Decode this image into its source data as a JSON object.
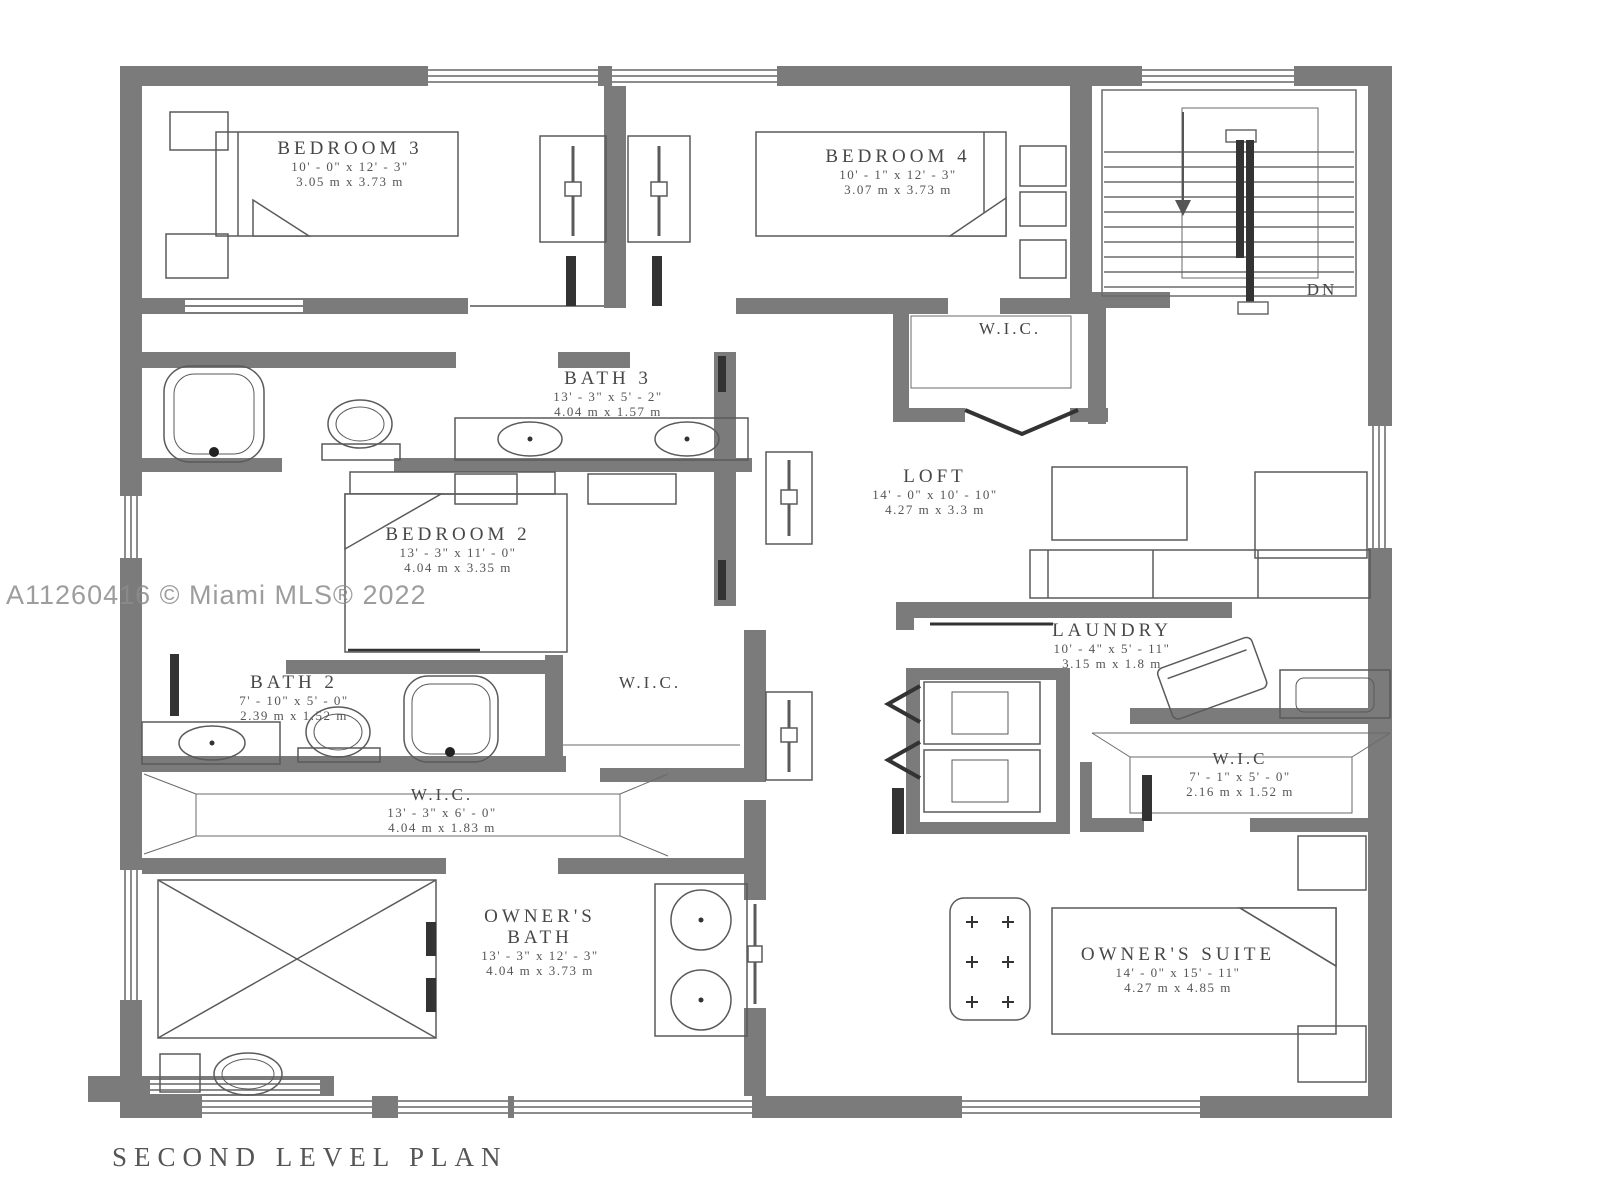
{
  "title": "SECOND LEVEL PLAN",
  "watermark": "A11260416 © Miami MLS® 2022",
  "colors": {
    "wall": "#7b7b7b",
    "line": "#5a5a5a",
    "text": "#474747"
  },
  "stairs": {
    "label": "DN"
  },
  "rooms": {
    "bedroom3": {
      "name": "BEDROOM 3",
      "dims_ft": "10' - 0\" x 12' - 3\"",
      "dims_m": "3.05 m x 3.73 m"
    },
    "bedroom4": {
      "name": "BEDROOM 4",
      "dims_ft": "10' - 1\" x 12' - 3\"",
      "dims_m": "3.07 m x 3.73 m"
    },
    "wic_top": {
      "name": "W.I.C."
    },
    "bath3": {
      "name": "BATH 3",
      "dims_ft": "13' - 3\" x 5' - 2\"",
      "dims_m": "4.04 m x 1.57 m"
    },
    "loft": {
      "name": "LOFT",
      "dims_ft": "14' - 0\" x 10' - 10\"",
      "dims_m": "4.27 m x 3.3 m"
    },
    "bedroom2": {
      "name": "BEDROOM 2",
      "dims_ft": "13' - 3\" x 11' - 0\"",
      "dims_m": "4.04 m x 3.35 m"
    },
    "laundry": {
      "name": "LAUNDRY",
      "dims_ft": "10' - 4\" x 5' - 11\"",
      "dims_m": "3.15 m x 1.8 m"
    },
    "bath2": {
      "name": "BATH 2",
      "dims_ft": "7' - 10\" x 5' - 0\"",
      "dims_m": "2.39 m x 1.52 m"
    },
    "wic_mid": {
      "name": "W.I.C."
    },
    "wic_right": {
      "name": "W.I.C",
      "dims_ft": "7' - 1\" x 5' - 0\"",
      "dims_m": "2.16 m x 1.52 m"
    },
    "wic_large": {
      "name": "W.I.C.",
      "dims_ft": "13' - 3\" x 6' - 0\"",
      "dims_m": "4.04 m x 1.83 m"
    },
    "owners_bath": {
      "name_top": "OWNER'S",
      "name_bottom": "BATH",
      "dims_ft": "13' - 3\" x 12' - 3\"",
      "dims_m": "4.04 m x 3.73 m"
    },
    "owners_suite": {
      "name": "OWNER'S SUITE",
      "dims_ft": "14' - 0\" x 15' - 11\"",
      "dims_m": "4.27 m x 4.85 m"
    }
  }
}
